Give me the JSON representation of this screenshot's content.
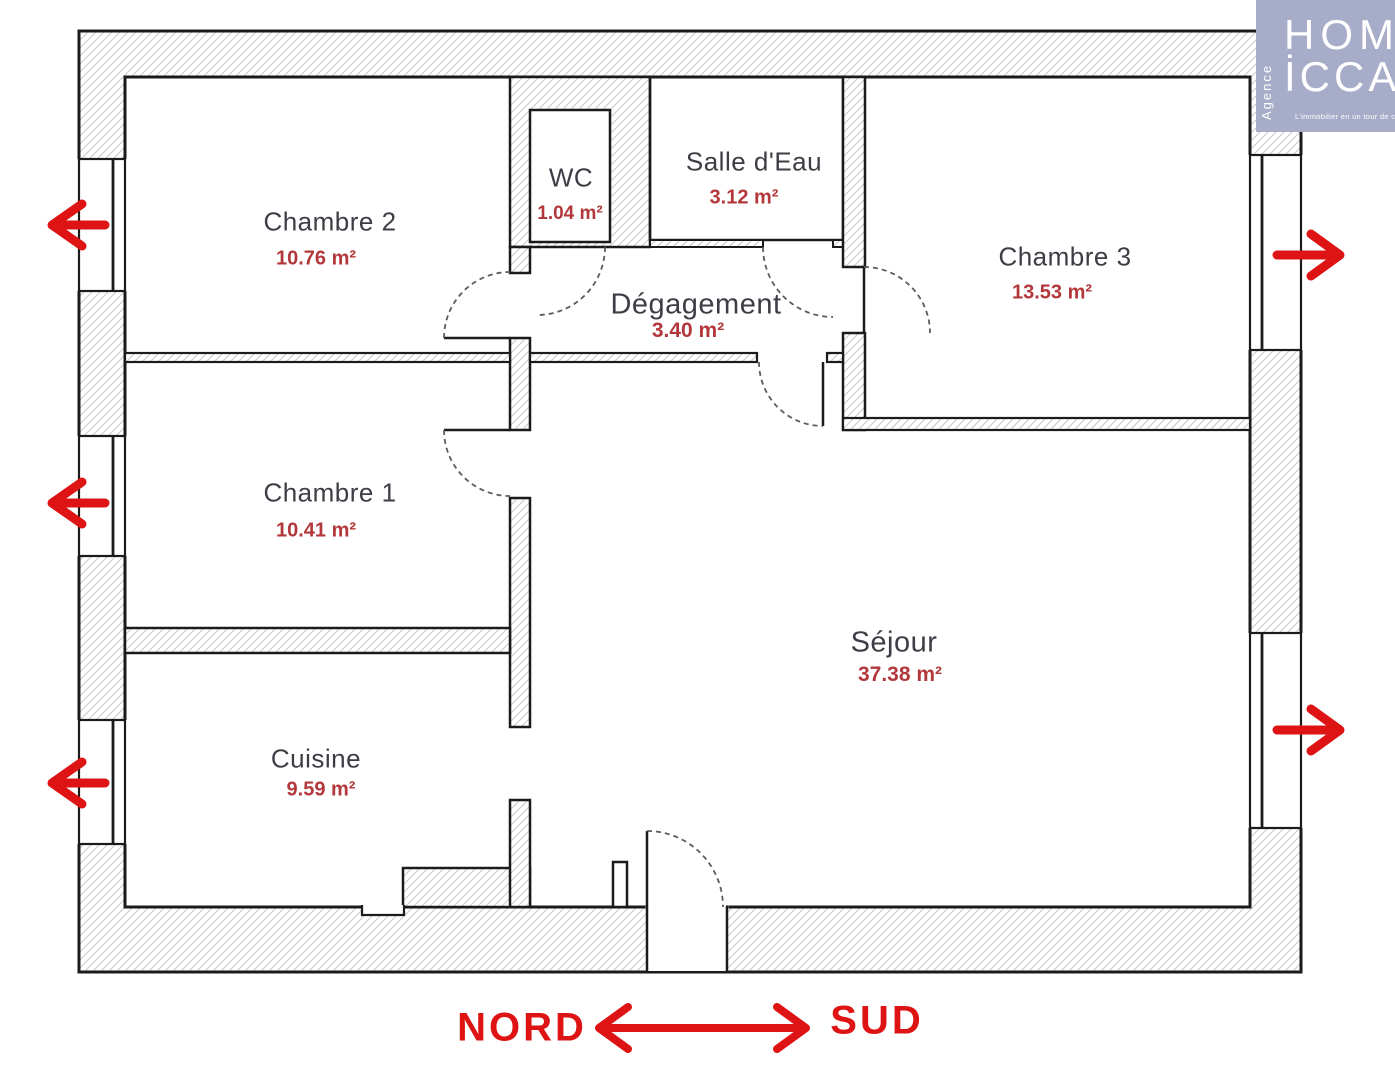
{
  "logo": {
    "brand_line1": "HOM",
    "brand_line2": "İCCA",
    "vertical_label": "Agence",
    "tagline": "L'immobilier en un tour de clé",
    "bg_color": "#a7acc8",
    "text_color": "#ffffff"
  },
  "compass": {
    "left_label": "NORD",
    "right_label": "SUD",
    "color": "#de1414"
  },
  "rooms": [
    {
      "name": "Chambre 2",
      "area": "10.76 m²"
    },
    {
      "name": "WC",
      "area": "1.04 m²"
    },
    {
      "name": "Salle d'Eau",
      "area": "3.12 m²"
    },
    {
      "name": "Chambre 3",
      "area": "13.53 m²"
    },
    {
      "name": "Dégagement",
      "area": "3.40 m²"
    },
    {
      "name": "Chambre 1",
      "area": "10.41 m²"
    },
    {
      "name": "Séjour",
      "area": "37.38 m²"
    },
    {
      "name": "Cuisine",
      "area": "9.59 m²"
    }
  ],
  "colors": {
    "room_name": "#3e3d45",
    "room_area": "#b3383b",
    "wall_line": "#1b1b1b",
    "hatch": "#cbcbcb",
    "arrow_red": "#de1414"
  }
}
